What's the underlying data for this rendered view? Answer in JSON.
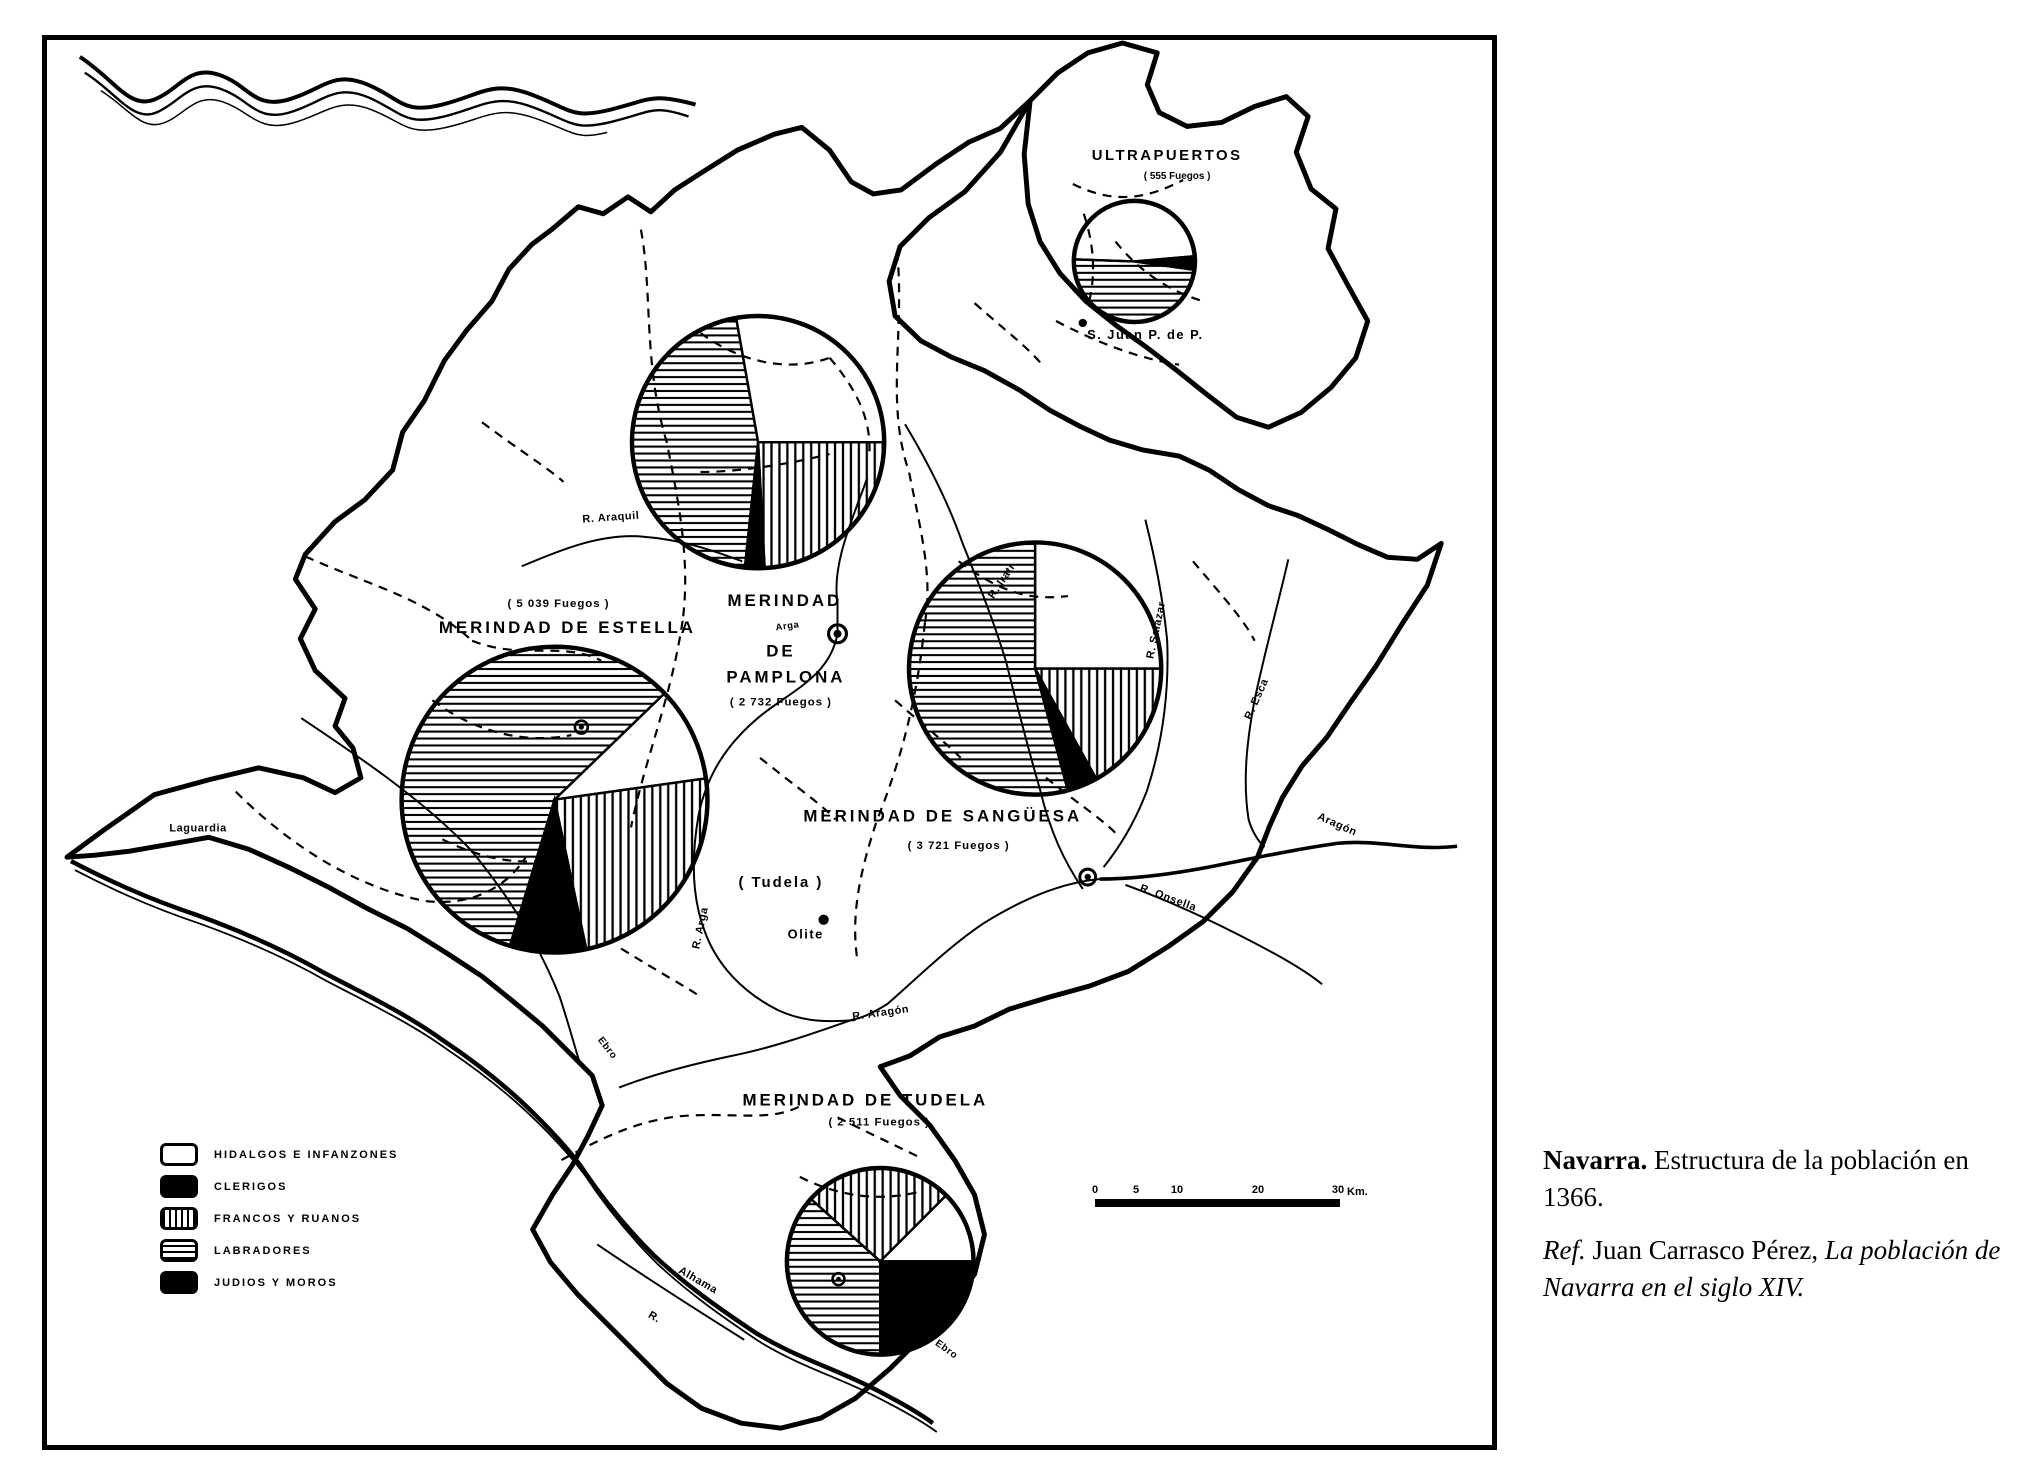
{
  "caption": {
    "title_bold": "Navarra.",
    "title_rest": " Estructura de la población en 1366.",
    "ref_label": "Ref.",
    "ref_mid": " Juan Carrasco Pérez, ",
    "ref_title": "La población de Navarra en el siglo XIV."
  },
  "legend": {
    "items": [
      {
        "label": "HIDALGOS E INFANZONES",
        "pattern": "white"
      },
      {
        "label": "CLERIGOS",
        "pattern": "black"
      },
      {
        "label": "FRANCOS Y RUANOS",
        "pattern": "vertical"
      },
      {
        "label": "LABRADORES",
        "pattern": "horizontal"
      },
      {
        "label": "JUDIOS Y MOROS",
        "pattern": "black"
      }
    ]
  },
  "scale_bar": {
    "ticks": [
      "0",
      "5",
      "10",
      "20",
      "30"
    ],
    "unit": "Km."
  },
  "labels": {
    "ultrapuertos_name": "ULTRAPUERTOS",
    "ultrapuertos_fuegos": "( 555 Fuegos )",
    "san_juan": "S. Juan P. de P.",
    "pamplona_l1": "MERINDAD",
    "pamplona_l2": "DE",
    "pamplona_l3": "PAMPLONA",
    "pamplona_fuegos": "( 2 732 Fuegos )",
    "estella_fuegos": "( 5 039 Fuegos )",
    "estella_name": "MERINDAD DE ESTELLA",
    "sanguesa_name": "MERINDAD DE SANGÜESA",
    "sanguesa_fuegos": "( 3 721 Fuegos )",
    "tudela_name": "MERINDAD DE TUDELA",
    "tudela_fuegos": "( 2 511 Fuegos )",
    "tudela_paren": "( Tudela )",
    "olite": "Olite",
    "laguardia": "Laguardia",
    "r_araquil": "R. Araquil",
    "arga": "Arga",
    "r_arga": "R. Arga",
    "r_aragon": "R. Aragón",
    "aragon": "Aragón",
    "r_onsella": "R. Onsella",
    "r_salazar": "R. Salazar",
    "r_esca": "R. Esca",
    "r_irati": "R. Irati",
    "ebro1": "Ebro",
    "ebro2": "Ebro",
    "alhama": "Alhama",
    "r_prefix": "R."
  },
  "chart_data": [
    {
      "type": "pie",
      "id": "ultrapuertos",
      "name": "ULTRAPUERTOS",
      "fuegos": 555,
      "center_x": 1137,
      "center_y": 258,
      "radius": 61,
      "sectors": [
        {
          "category": "hidalgos_e_infanzones",
          "pattern": "white",
          "start_deg": 272,
          "end_deg": 445,
          "percent_approx": 48
        },
        {
          "category": "clerigos",
          "pattern": "black",
          "start_deg": 85,
          "end_deg": 98,
          "percent_approx": 4
        },
        {
          "category": "labradores",
          "pattern": "horizontal",
          "start_deg": 98,
          "end_deg": 272,
          "percent_approx": 48
        }
      ]
    },
    {
      "type": "pie",
      "id": "pamplona",
      "name": "MERINDAD DE PAMPLONA",
      "fuegos": 2732,
      "center_x": 758,
      "center_y": 440,
      "radius": 127,
      "sectors": [
        {
          "category": "hidalgos_e_infanzones",
          "pattern": "white",
          "start_deg": 350,
          "end_deg": 450,
          "percent_approx": 28
        },
        {
          "category": "francos_y_ruanos",
          "pattern": "vertical",
          "start_deg": 90,
          "end_deg": 177,
          "percent_approx": 24
        },
        {
          "category": "clerigos",
          "pattern": "black",
          "start_deg": 177,
          "end_deg": 186,
          "percent_approx": 2
        },
        {
          "category": "labradores",
          "pattern": "horizontal",
          "start_deg": 186,
          "end_deg": 350,
          "percent_approx": 46
        }
      ]
    },
    {
      "type": "pie",
      "id": "estella",
      "name": "MERINDAD DE ESTELLA",
      "fuegos": 5039,
      "center_x": 553,
      "center_y": 800,
      "radius": 154,
      "sectors": [
        {
          "category": "hidalgos_e_infanzones",
          "pattern": "white",
          "start_deg": 46,
          "end_deg": 82,
          "percent_approx": 10
        },
        {
          "category": "francos_y_ruanos",
          "pattern": "vertical",
          "start_deg": 82,
          "end_deg": 168,
          "percent_approx": 24
        },
        {
          "category": "judios_y_moros",
          "pattern": "black",
          "start_deg": 168,
          "end_deg": 197,
          "percent_approx": 8
        },
        {
          "category": "labradores",
          "pattern": "horizontal",
          "start_deg": 197,
          "end_deg": 406,
          "percent_approx": 58
        }
      ]
    },
    {
      "type": "pie",
      "id": "sanguesa",
      "name": "MERINDAD DE SANGÜESA",
      "fuegos": 3721,
      "center_x": 1037,
      "center_y": 668,
      "radius": 127,
      "sectors": [
        {
          "category": "hidalgos_e_infanzones",
          "pattern": "white",
          "start_deg": 0,
          "end_deg": 90,
          "percent_approx": 25
        },
        {
          "category": "francos_y_ruanos",
          "pattern": "vertical",
          "start_deg": 90,
          "end_deg": 151,
          "percent_approx": 17
        },
        {
          "category": "clerigos",
          "pattern": "black",
          "start_deg": 151,
          "end_deg": 165,
          "percent_approx": 4
        },
        {
          "category": "labradores",
          "pattern": "horizontal",
          "start_deg": 165,
          "end_deg": 360,
          "percent_approx": 54
        }
      ]
    },
    {
      "type": "pie",
      "id": "tudela",
      "name": "MERINDAD DE TUDELA",
      "fuegos": 2511,
      "center_x": 881,
      "center_y": 1265,
      "radius": 94,
      "sectors": [
        {
          "category": "francos_y_ruanos",
          "pattern": "vertical",
          "start_deg": 312,
          "end_deg": 405,
          "percent_approx": 26
        },
        {
          "category": "hidalgos_e_infanzones",
          "pattern": "white",
          "start_deg": 45,
          "end_deg": 90,
          "percent_approx": 12
        },
        {
          "category": "judios_y_moros",
          "pattern": "black",
          "start_deg": 90,
          "end_deg": 180,
          "percent_approx": 25
        },
        {
          "category": "labradores",
          "pattern": "horizontal",
          "start_deg": 180,
          "end_deg": 312,
          "percent_approx": 37
        }
      ]
    }
  ]
}
